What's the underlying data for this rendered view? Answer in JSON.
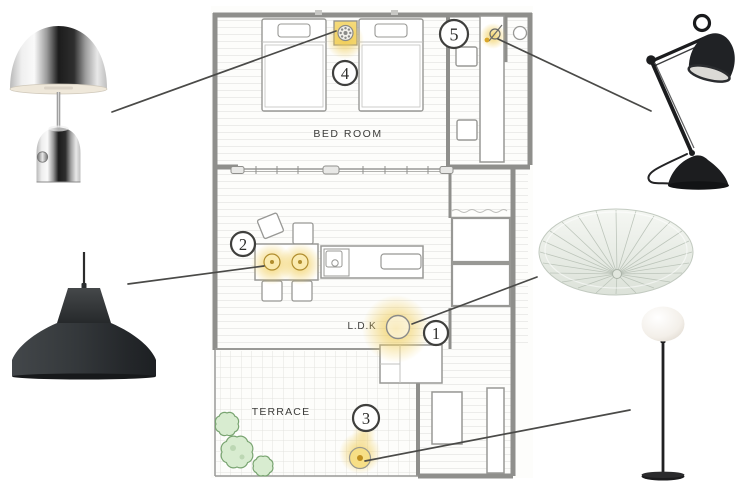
{
  "plan": {
    "labels": {
      "bedroom": "BED ROOM",
      "ldk": "L.D.K",
      "terrace": "TERRACE"
    }
  },
  "markers": {
    "m1": "1",
    "m2": "2",
    "m3": "3",
    "m4": "4",
    "m5": "5"
  },
  "products": {
    "table_lamp": "chrome-bell-table-lamp",
    "pendant_lamp": "black-workshop-pendant-lamp",
    "desk_lamp": "black-articulated-desk-lamp",
    "ceiling_lamp": "white-pleated-ceiling-lamp",
    "floor_lamp": "white-globe-floor-lamp"
  },
  "colors": {
    "glow": "#f0cc55",
    "wall": "#8f8f8c",
    "furniture_stroke": "#989895",
    "connector": "#4a4a48",
    "marker_stroke": "#3f3f3d",
    "label_text": "#3c3c3a",
    "plant_fill": "#d8ecd0",
    "plant_stroke": "#79a471",
    "pendant_symbol": "#b08d2e",
    "lamp_black": "#232527"
  }
}
